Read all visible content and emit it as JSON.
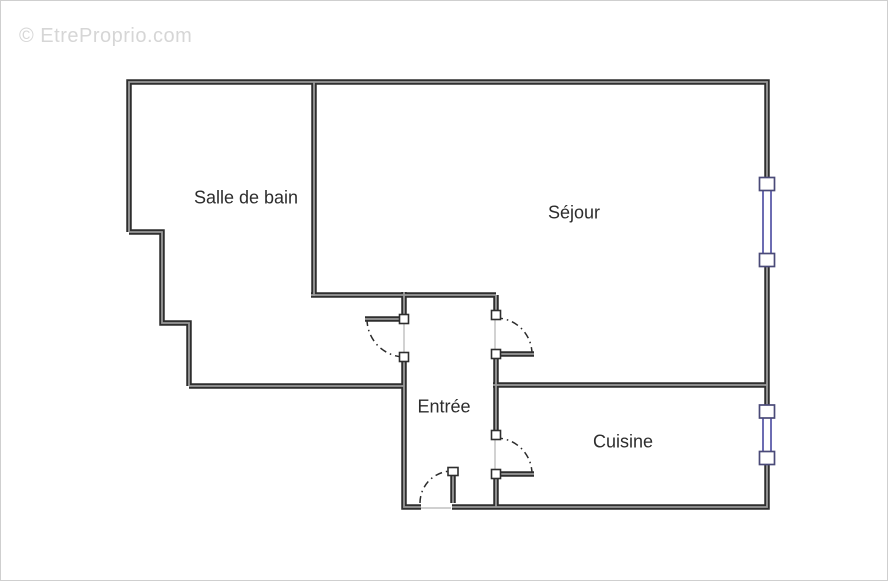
{
  "watermark": {
    "text": "© EtreProprio.com"
  },
  "plan": {
    "rooms": [
      {
        "id": "bathroom",
        "label": "Salle de bain"
      },
      {
        "id": "living-room",
        "label": "Séjour"
      },
      {
        "id": "entrance",
        "label": "Entrée"
      },
      {
        "id": "kitchen",
        "label": "Cuisine"
      }
    ],
    "colors": {
      "wall": "#2e2e2e",
      "wall_inner": "#9a9a9a",
      "window_frame": "#3c3c99",
      "window_post": "#4a4a78",
      "door_thin": "#b5b5b5",
      "arc": "#2b2b2b",
      "label_text": "#2d2d2d",
      "watermark": "#d6d6d6",
      "background": "#ffffff",
      "canvas_border": "#cfcfcf"
    }
  }
}
